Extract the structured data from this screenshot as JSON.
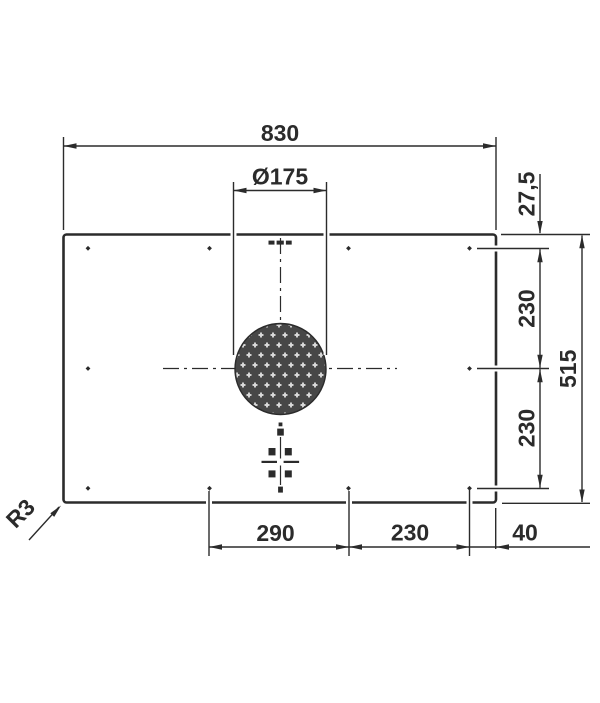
{
  "dimensions": {
    "overall_width": "830",
    "vent_diameter": "Ø175",
    "top_edge_to_first_row": "27,5",
    "first_to_second_row": "230",
    "second_to_third_row": "230",
    "overall_depth": "515",
    "bottom_left_span": "290",
    "bottom_mid_span": "230",
    "bottom_right_span": "40",
    "corner_radius": "R3"
  },
  "colors": {
    "line": "#2b2b2b",
    "background": "#ffffff",
    "vent_fill": "#474747",
    "vent_perforation": "#d9d9d9"
  }
}
